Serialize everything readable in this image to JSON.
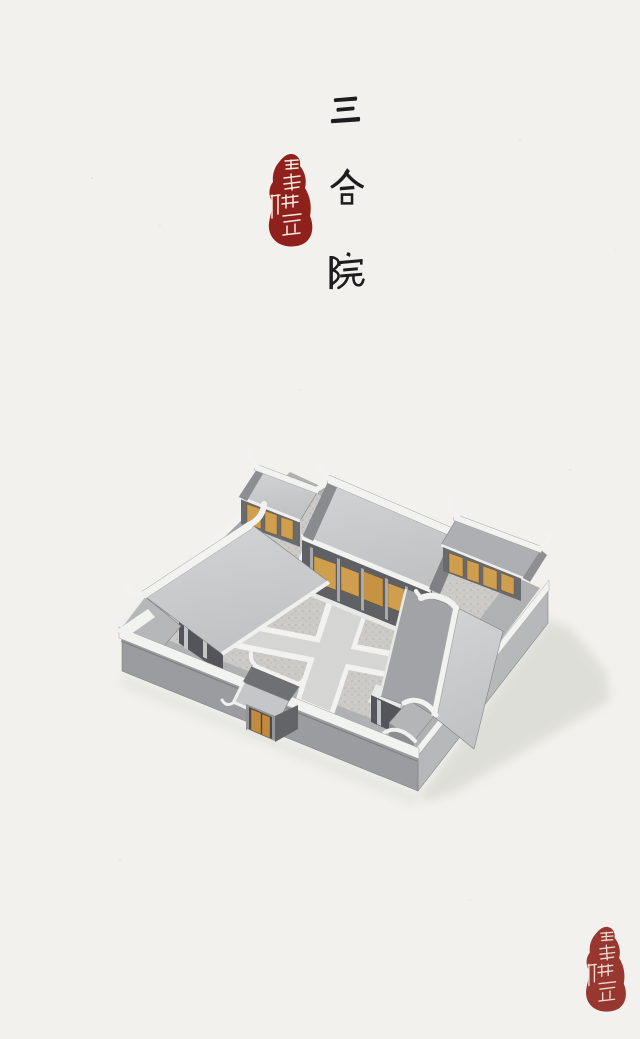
{
  "title": {
    "text": "三合院",
    "characters": [
      "三",
      "合",
      "院"
    ],
    "orientation": "vertical"
  },
  "seal": {
    "text": "星球研究所"
  },
  "watermark": {
    "text": "星球研究所"
  },
  "illustration": {
    "colors": {
      "paper": "#f2f1ed",
      "ink": "#1d1d1d",
      "sealRed": "#8e211b",
      "sealText": "#f3ece2",
      "watermark": "#e4e3de",
      "trimWhite": "#f2f2f0",
      "roofLight": "#c9cacc",
      "roofMid": "#a6a7aa",
      "roofDark": "#6f7073",
      "wall": "#9b9c9f",
      "wallLight": "#b7b8ba",
      "porchShadow": "#5a5b5f",
      "wood": "#cf9e4f",
      "courtPath": "#d5d5d3",
      "gravel": "#cbcac7",
      "castShadow": "#dbdbd6"
    }
  }
}
